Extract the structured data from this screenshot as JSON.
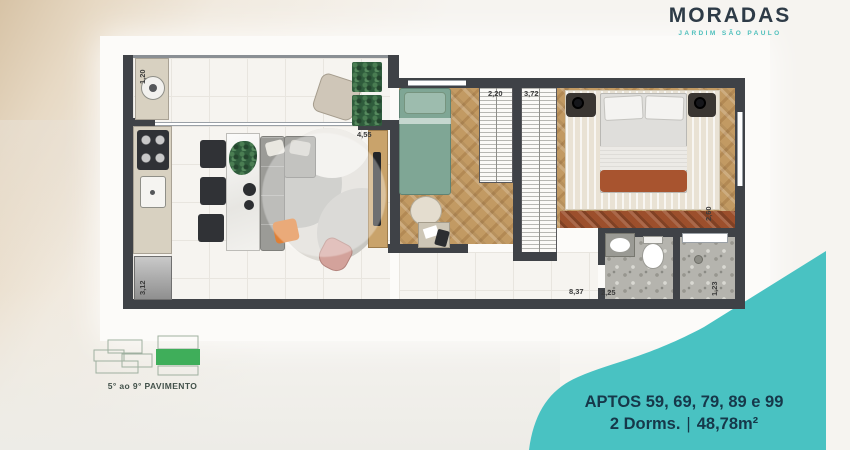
{
  "brand": {
    "name": "MORADAS",
    "subtitle": "JARDIM SÃO PAULO"
  },
  "floor_badge": {
    "label": "5° ao 9° PAVIMENTO"
  },
  "unit_info": {
    "line1": "APTOS 59, 69, 79, 89 e 99",
    "dorms": "2 Dorms.",
    "separator": "|",
    "area": "48,78m²"
  },
  "dimensions": {
    "service_width": "1,20",
    "kitchen_depth": "3,12",
    "living_width": "4,55",
    "closet_1": "2,20",
    "closet_2": "3,72",
    "suite_side": "2,60",
    "service_area": "1,23",
    "total_width": "8,37",
    "bath_width": "2,25"
  },
  "colors": {
    "teal": "#49C2C2",
    "navy_text": "#16384A",
    "brand_navy": "#2E3B47",
    "floor_green": "#3FAE5A",
    "wall": "#3F4247",
    "wood_floor": "#C29A63",
    "accent_orange": "#E07F35"
  }
}
